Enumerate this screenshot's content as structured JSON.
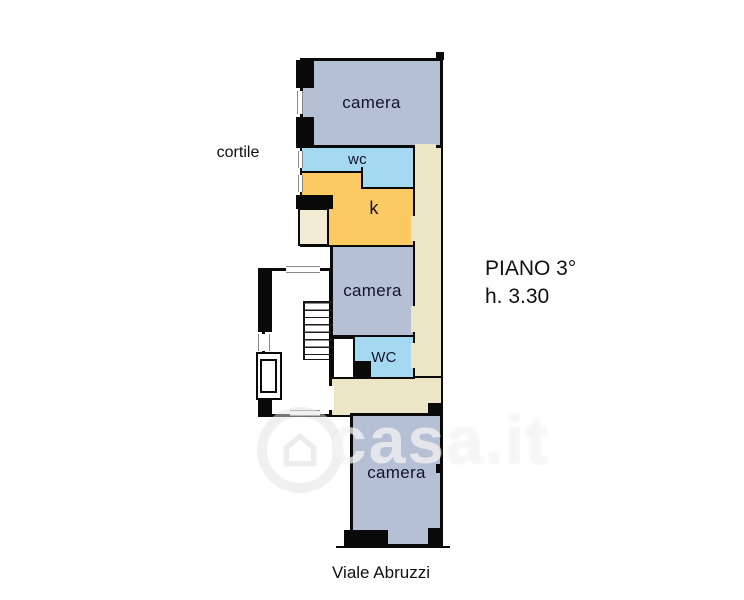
{
  "labels": {
    "courtyard": "cortile",
    "floor": "PIANO 3°",
    "ceiling_height": "h. 3.30",
    "street": "Viale Abruzzi"
  },
  "rooms": {
    "camera_top": "camera",
    "wc_top": "wc",
    "kitchen": "k",
    "camera_middle": "camera",
    "wc_middle": "WC",
    "camera_bottom": "camera"
  },
  "watermark": {
    "text": "casa.it",
    "icon": "house-circle-icon"
  },
  "colors": {
    "bedroom": "#b6c0d5",
    "bathroom": "#a5d9f2",
    "kitchen": "#fbca63",
    "corridor": "#ece6c6",
    "balcony": "#f2ecd4",
    "wall": "#0a0a0a",
    "label_text": "#14142a",
    "annotation_text": "#111111",
    "watermark": "#ffffff"
  }
}
